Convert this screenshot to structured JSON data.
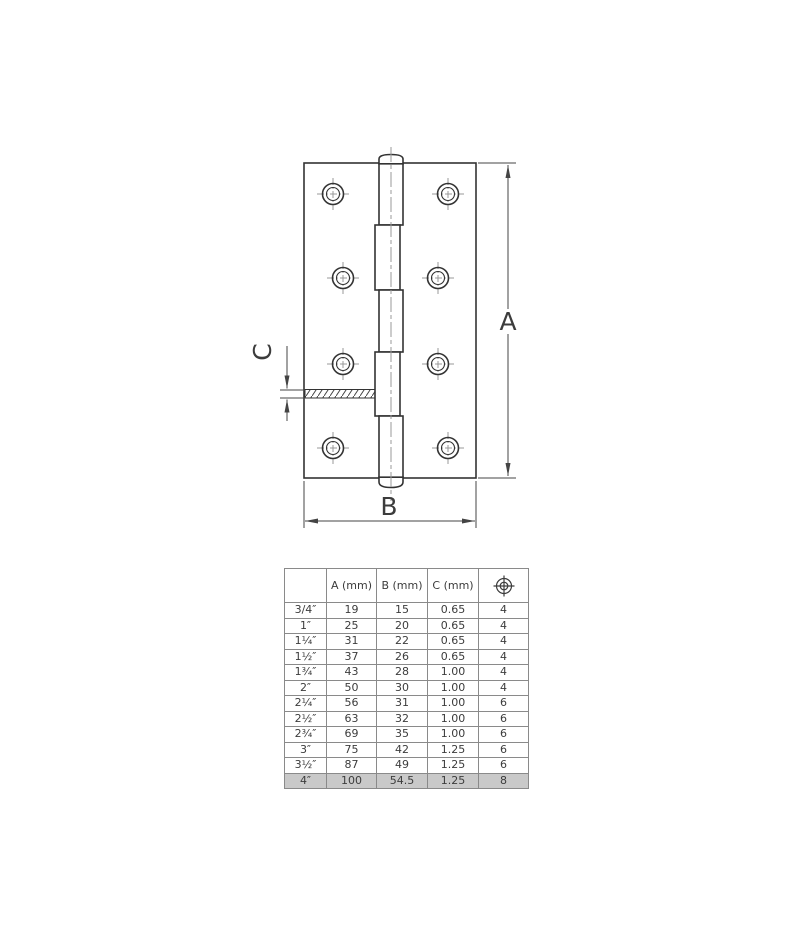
{
  "drawing": {
    "labels": {
      "a": "A",
      "b": "B",
      "c": "C"
    }
  },
  "table": {
    "headers": {
      "size": "",
      "a": "A (mm)",
      "b": "B (mm)",
      "c": "C (mm)"
    },
    "screw_column_icon": "screw-position-icon",
    "rows": [
      {
        "size": "3/4″",
        "a": "19",
        "b": "15",
        "c": "0.65",
        "screws": "4"
      },
      {
        "size": "1″",
        "a": "25",
        "b": "20",
        "c": "0.65",
        "screws": "4"
      },
      {
        "size": "1¼″",
        "a": "31",
        "b": "22",
        "c": "0.65",
        "screws": "4"
      },
      {
        "size": "1½″",
        "a": "37",
        "b": "26",
        "c": "0.65",
        "screws": "4"
      },
      {
        "size": "1¾″",
        "a": "43",
        "b": "28",
        "c": "1.00",
        "screws": "4"
      },
      {
        "size": "2″",
        "a": "50",
        "b": "30",
        "c": "1.00",
        "screws": "4"
      },
      {
        "size": "2¼″",
        "a": "56",
        "b": "31",
        "c": "1.00",
        "screws": "6"
      },
      {
        "size": "2½″",
        "a": "63",
        "b": "32",
        "c": "1.00",
        "screws": "6"
      },
      {
        "size": "2¾″",
        "a": "69",
        "b": "35",
        "c": "1.00",
        "screws": "6"
      },
      {
        "size": "3″",
        "a": "75",
        "b": "42",
        "c": "1.25",
        "screws": "6"
      },
      {
        "size": "3½″",
        "a": "87",
        "b": "49",
        "c": "1.25",
        "screws": "6"
      },
      {
        "size": "4″",
        "a": "100",
        "b": "54.5",
        "c": "1.25",
        "screws": "8"
      }
    ],
    "highlighted_size": "4″"
  },
  "colors": {
    "object_line": "#333333",
    "dimension_line": "#444444",
    "centerline": "#999999",
    "table_border": "#8a8a8a",
    "text": "#3c3c3c",
    "highlight_row_bg": "#c9c9c9"
  }
}
